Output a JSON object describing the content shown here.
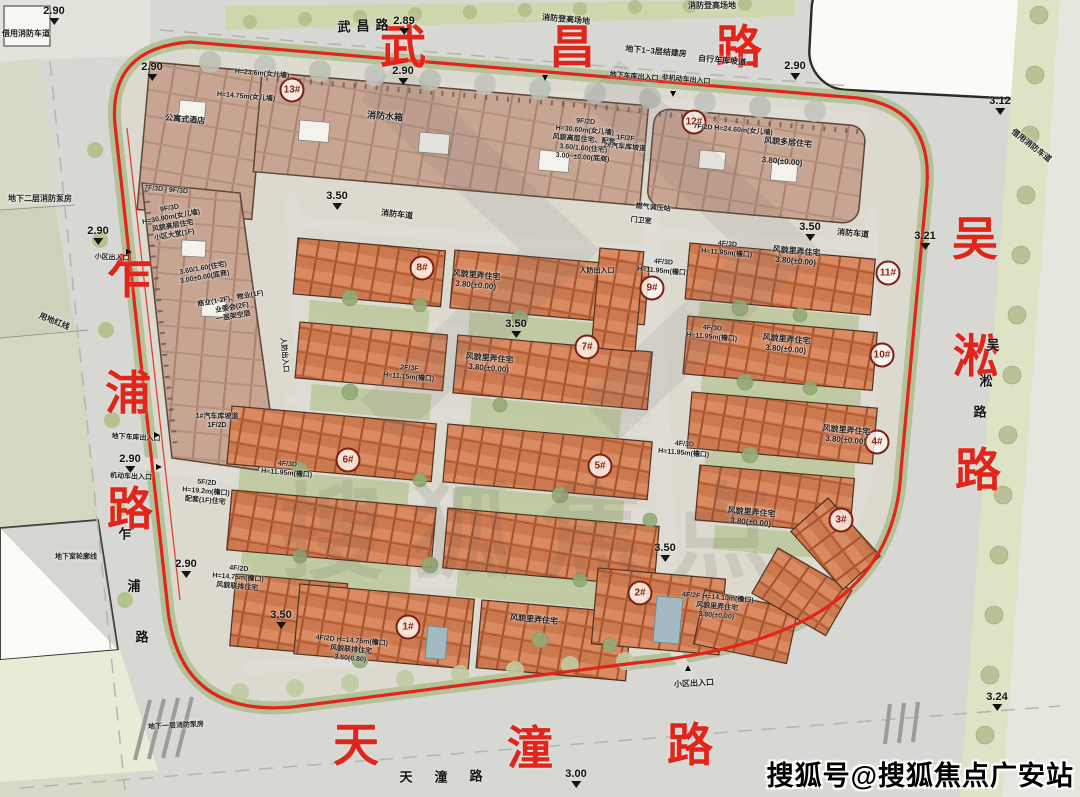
{
  "watermark": {
    "corner": "搜狐号@搜狐焦点广安站",
    "ghost": "搜狐焦点"
  },
  "road_labels": [
    {
      "name": "wuchang-road-label-red",
      "cls": "big-red",
      "chars": [
        {
          "c": "武",
          "x": 403,
          "y": 44
        },
        {
          "c": "昌",
          "x": 572,
          "y": 44
        },
        {
          "c": "路",
          "x": 739,
          "y": 44
        }
      ]
    },
    {
      "name": "zhapu-road-label-red",
      "cls": "big-red",
      "chars": [
        {
          "c": "乍",
          "x": 130,
          "y": 274
        },
        {
          "c": "浦",
          "x": 128,
          "y": 390
        },
        {
          "c": "路",
          "x": 130,
          "y": 506
        }
      ]
    },
    {
      "name": "wusong-road-label-red",
      "cls": "big-red",
      "chars": [
        {
          "c": "吴",
          "x": 975,
          "y": 236
        },
        {
          "c": "淞",
          "x": 976,
          "y": 353
        },
        {
          "c": "路",
          "x": 978,
          "y": 467
        }
      ]
    },
    {
      "name": "tiantong-road-label-red",
      "cls": "big-red",
      "chars": [
        {
          "c": "天",
          "x": 356,
          "y": 742
        },
        {
          "c": "潼",
          "x": 530,
          "y": 745
        },
        {
          "c": "路",
          "x": 690,
          "y": 742
        }
      ]
    },
    {
      "name": "wuchang-road-label-small",
      "cls": "small-black",
      "chars": [
        {
          "c": "武",
          "x": 344,
          "y": 26
        },
        {
          "c": "昌",
          "x": 363,
          "y": 25
        },
        {
          "c": "路",
          "x": 382,
          "y": 24
        }
      ]
    },
    {
      "name": "zhapu-road-label-small",
      "cls": "small-black",
      "chars": [
        {
          "c": "乍",
          "x": 125,
          "y": 533
        },
        {
          "c": "浦",
          "x": 134,
          "y": 585
        },
        {
          "c": "路",
          "x": 142,
          "y": 636
        }
      ]
    },
    {
      "name": "wusong-road-label-small",
      "cls": "small-black",
      "chars": [
        {
          "c": "吴",
          "x": 993,
          "y": 344
        },
        {
          "c": "淞",
          "x": 986,
          "y": 380
        },
        {
          "c": "路",
          "x": 980,
          "y": 411
        }
      ]
    },
    {
      "name": "tiantong-road-label-small",
      "cls": "small-black",
      "chars": [
        {
          "c": "天",
          "x": 406,
          "y": 776
        },
        {
          "c": "潼",
          "x": 441,
          "y": 776
        },
        {
          "c": "路",
          "x": 476,
          "y": 775
        }
      ]
    }
  ],
  "elevations": [
    {
      "v": "2.90",
      "x": 54,
      "y": 6
    },
    {
      "v": "2.90",
      "x": 152,
      "y": 62
    },
    {
      "v": "2.89",
      "x": 404,
      "y": 16
    },
    {
      "v": "2.90",
      "x": 403,
      "y": 66
    },
    {
      "v": "2.90",
      "x": 795,
      "y": 61
    },
    {
      "v": "3.12",
      "x": 1000,
      "y": 96
    },
    {
      "v": "3.21",
      "x": 925,
      "y": 231
    },
    {
      "v": "2.90",
      "x": 98,
      "y": 226
    },
    {
      "v": "2.90",
      "x": 130,
      "y": 454
    },
    {
      "v": "2.90",
      "x": 186,
      "y": 559
    },
    {
      "v": "3.50",
      "x": 337,
      "y": 191
    },
    {
      "v": "3.50",
      "x": 810,
      "y": 222
    },
    {
      "v": "3.50",
      "x": 516,
      "y": 319
    },
    {
      "v": "3.50",
      "x": 665,
      "y": 543
    },
    {
      "v": "3.50",
      "x": 281,
      "y": 610
    },
    {
      "v": "3.00",
      "x": 576,
      "y": 769
    },
    {
      "v": "3.24",
      "x": 997,
      "y": 692
    }
  ],
  "building_markers": [
    {
      "no": "1#",
      "x": 408,
      "y": 627
    },
    {
      "no": "2#",
      "x": 640,
      "y": 593
    },
    {
      "no": "3#",
      "x": 841,
      "y": 520
    },
    {
      "no": "4#",
      "x": 877,
      "y": 442
    },
    {
      "no": "5#",
      "x": 600,
      "y": 466
    },
    {
      "no": "6#",
      "x": 348,
      "y": 460
    },
    {
      "no": "7#",
      "x": 587,
      "y": 347
    },
    {
      "no": "8#",
      "x": 422,
      "y": 268
    },
    {
      "no": "9#",
      "x": 652,
      "y": 288
    },
    {
      "no": "10#",
      "x": 882,
      "y": 355
    },
    {
      "no": "11#",
      "x": 888,
      "y": 273
    },
    {
      "no": "12#",
      "x": 694,
      "y": 122
    },
    {
      "no": "13#",
      "x": 292,
      "y": 90
    }
  ],
  "annotations": [
    {
      "t": "消防登高场地",
      "x": 566,
      "y": 20,
      "r": 5
    },
    {
      "t": "消防登高场地",
      "x": 712,
      "y": 6,
      "r": 0
    },
    {
      "t": "地下1~3层结建房",
      "x": 656,
      "y": 52,
      "r": 5
    },
    {
      "t": "自行车库坡道",
      "x": 722,
      "y": 61,
      "r": 5
    },
    {
      "t": "地下车库出入口",
      "x": 634,
      "y": 77,
      "r": 5,
      "s": 7
    },
    {
      "t": "非机动车出入口",
      "x": 686,
      "y": 80,
      "r": 5,
      "s": 7
    },
    {
      "t": "借用消防车道",
      "x": 26,
      "y": 34,
      "r": 0
    },
    {
      "t": "借用消防车道",
      "x": 1031,
      "y": 146,
      "r": 38
    },
    {
      "t": "地下二层消防泵房",
      "x": 40,
      "y": 199,
      "r": 0
    },
    {
      "t": "用地红线",
      "x": 54,
      "y": 322,
      "r": 22
    },
    {
      "t": "小区出入口",
      "x": 112,
      "y": 258,
      "r": 3,
      "s": 7
    },
    {
      "t": "地下车库出入口",
      "x": 136,
      "y": 438,
      "r": 3,
      "s": 7
    },
    {
      "t": "机动车出入口",
      "x": 131,
      "y": 477,
      "r": 3,
      "s": 7
    },
    {
      "t": "小区出入口",
      "x": 694,
      "y": 684,
      "r": -3
    },
    {
      "t": "地下室轮廓线",
      "x": 76,
      "y": 557,
      "r": 0,
      "s": 7
    },
    {
      "t": "地下一层消防泵房",
      "x": 176,
      "y": 726,
      "r": -3,
      "s": 7
    },
    {
      "t": "燃气调压站",
      "x": 653,
      "y": 208,
      "r": 5,
      "s": 7
    },
    {
      "t": "门卫室",
      "x": 641,
      "y": 221,
      "r": 5,
      "s": 7
    },
    {
      "t": "人防出入口",
      "x": 597,
      "y": 271,
      "r": 0,
      "s": 7
    },
    {
      "t": "人防出入口",
      "x": 284,
      "y": 355,
      "r": 85,
      "s": 7
    },
    {
      "t": "消防车道",
      "x": 853,
      "y": 234,
      "r": 5
    },
    {
      "t": "消防车道",
      "x": 397,
      "y": 215,
      "r": 6
    },
    {
      "t": "消防水箱",
      "x": 385,
      "y": 117,
      "r": 5,
      "s": 9
    },
    {
      "lines": [
        "9F/2D",
        "H=30.60m(女儿墙)",
        "风貌高层住宅、配套",
        "3.60/1.60(住宅)",
        "3.00~±0.00(底商)"
      ],
      "x": 584,
      "y": 140,
      "r": 5,
      "s": 7
    },
    {
      "lines": [
        "1F/2F",
        "2#汽车库坡道"
      ],
      "x": 625,
      "y": 143,
      "r": 5,
      "s": 7
    },
    {
      "t": "7F/2D  H=24.60m(女儿墙)",
      "x": 733,
      "y": 130,
      "r": 5,
      "s": 7
    },
    {
      "t": "风貌多层住宅",
      "x": 788,
      "y": 143,
      "r": 5
    },
    {
      "t": "3.80(±0.00)",
      "x": 782,
      "y": 162,
      "r": 5
    },
    {
      "lines": [
        "9F/3D",
        "H=30.90m(女儿墙)",
        "风貌高层住宅",
        "小区大堂(1F)"
      ],
      "x": 172,
      "y": 222,
      "r": -10,
      "s": 7
    },
    {
      "lines": [
        "3.60/1.60(住宅)",
        "3.00±0.00(底商)"
      ],
      "x": 204,
      "y": 273,
      "r": -10,
      "s": 7
    },
    {
      "lines": [
        "商业(1-2F)、物业(1F)",
        "业委会(2F)",
        "一层架空层"
      ],
      "x": 232,
      "y": 308,
      "r": -10,
      "s": 7
    },
    {
      "lines": [
        "1#汽车库坡道",
        "1F/2D"
      ],
      "x": 217,
      "y": 421,
      "r": 0,
      "s": 7
    },
    {
      "t": "7F/3D | 9F/3D",
      "x": 166,
      "y": 190,
      "r": 5,
      "s": 7
    },
    {
      "t": "H=23.6m(女儿墙)",
      "x": 262,
      "y": 74,
      "r": 5,
      "s": 7
    },
    {
      "t": "H=14.75m(女儿墙)",
      "x": 246,
      "y": 97,
      "r": 5,
      "s": 7
    },
    {
      "t": "公寓式酒店",
      "x": 185,
      "y": 120,
      "r": 5
    },
    {
      "lines": [
        "风貌里弄住宅",
        "3.80(±0.00)"
      ],
      "x": 476,
      "y": 281,
      "r": 5
    },
    {
      "lines": [
        "风貌里弄住宅",
        "3.80(±0.00)"
      ],
      "x": 489,
      "y": 364,
      "r": 5
    },
    {
      "lines": [
        "风貌里弄住宅",
        "3.80(±0.00)"
      ],
      "x": 796,
      "y": 257,
      "r": 5
    },
    {
      "lines": [
        "风貌里弄住宅",
        "3.80(±0.00)"
      ],
      "x": 786,
      "y": 345,
      "r": 5
    },
    {
      "lines": [
        "风貌里弄住宅",
        "3.80(±0.00)"
      ],
      "x": 846,
      "y": 436,
      "r": 5
    },
    {
      "lines": [
        "风貌里弄住宅",
        "3.80(±0.00)"
      ],
      "x": 751,
      "y": 518,
      "r": 5
    },
    {
      "lines": [
        "4F/2F H=14.10m(檐口)",
        "风貌里弄住宅",
        "3.80(±0.00)"
      ],
      "x": 717,
      "y": 607,
      "r": 5,
      "s": 7
    },
    {
      "t": "风貌里弄住宅",
      "x": 534,
      "y": 620,
      "r": 5
    },
    {
      "lines": [
        "4F/2D H=14.75m(檐口)",
        "风貌联排住宅",
        "3.50(0.80)"
      ],
      "x": 351,
      "y": 650,
      "r": 5,
      "s": 7
    },
    {
      "lines": [
        "4F/2D",
        "H=14.75m(檐口)",
        "风貌联排住宅"
      ],
      "x": 238,
      "y": 578,
      "r": 5,
      "s": 7
    },
    {
      "lines": [
        "4F/3D",
        "H=11.95m(檐口)"
      ],
      "x": 727,
      "y": 249,
      "r": 5,
      "s": 7
    },
    {
      "lines": [
        "4F/3D",
        "H=11.95m(檐口)"
      ],
      "x": 663,
      "y": 267,
      "r": 5,
      "s": 7
    },
    {
      "lines": [
        "4F/3D",
        "H=11.95m(檐口)"
      ],
      "x": 712,
      "y": 333,
      "r": 5,
      "s": 7
    },
    {
      "lines": [
        "4F/3D",
        "H=11.95m(檐口)"
      ],
      "x": 287,
      "y": 469,
      "r": 5,
      "s": 7
    },
    {
      "lines": [
        "4F/3D",
        "H=11.95m(檐口)"
      ],
      "x": 684,
      "y": 449,
      "r": 5,
      "s": 7
    },
    {
      "lines": [
        "5F/2D",
        "H=19.2m(檐口)",
        "配套(1F)住宅"
      ],
      "x": 206,
      "y": 492,
      "r": 5,
      "s": 7
    },
    {
      "lines": [
        "2F/3F",
        "H=11.15m(檐口)"
      ],
      "x": 409,
      "y": 373,
      "r": 5,
      "s": 7
    }
  ],
  "entrance_arrows": [
    {
      "x": 128,
      "y": 252,
      "rot": 90
    },
    {
      "x": 156,
      "y": 435,
      "rot": 90
    },
    {
      "x": 158,
      "y": 467,
      "rot": 90
    },
    {
      "x": 688,
      "y": 669,
      "rot": 0
    },
    {
      "x": 545,
      "y": 77,
      "rot": 180
    },
    {
      "x": 673,
      "y": 93,
      "rot": 180
    }
  ]
}
